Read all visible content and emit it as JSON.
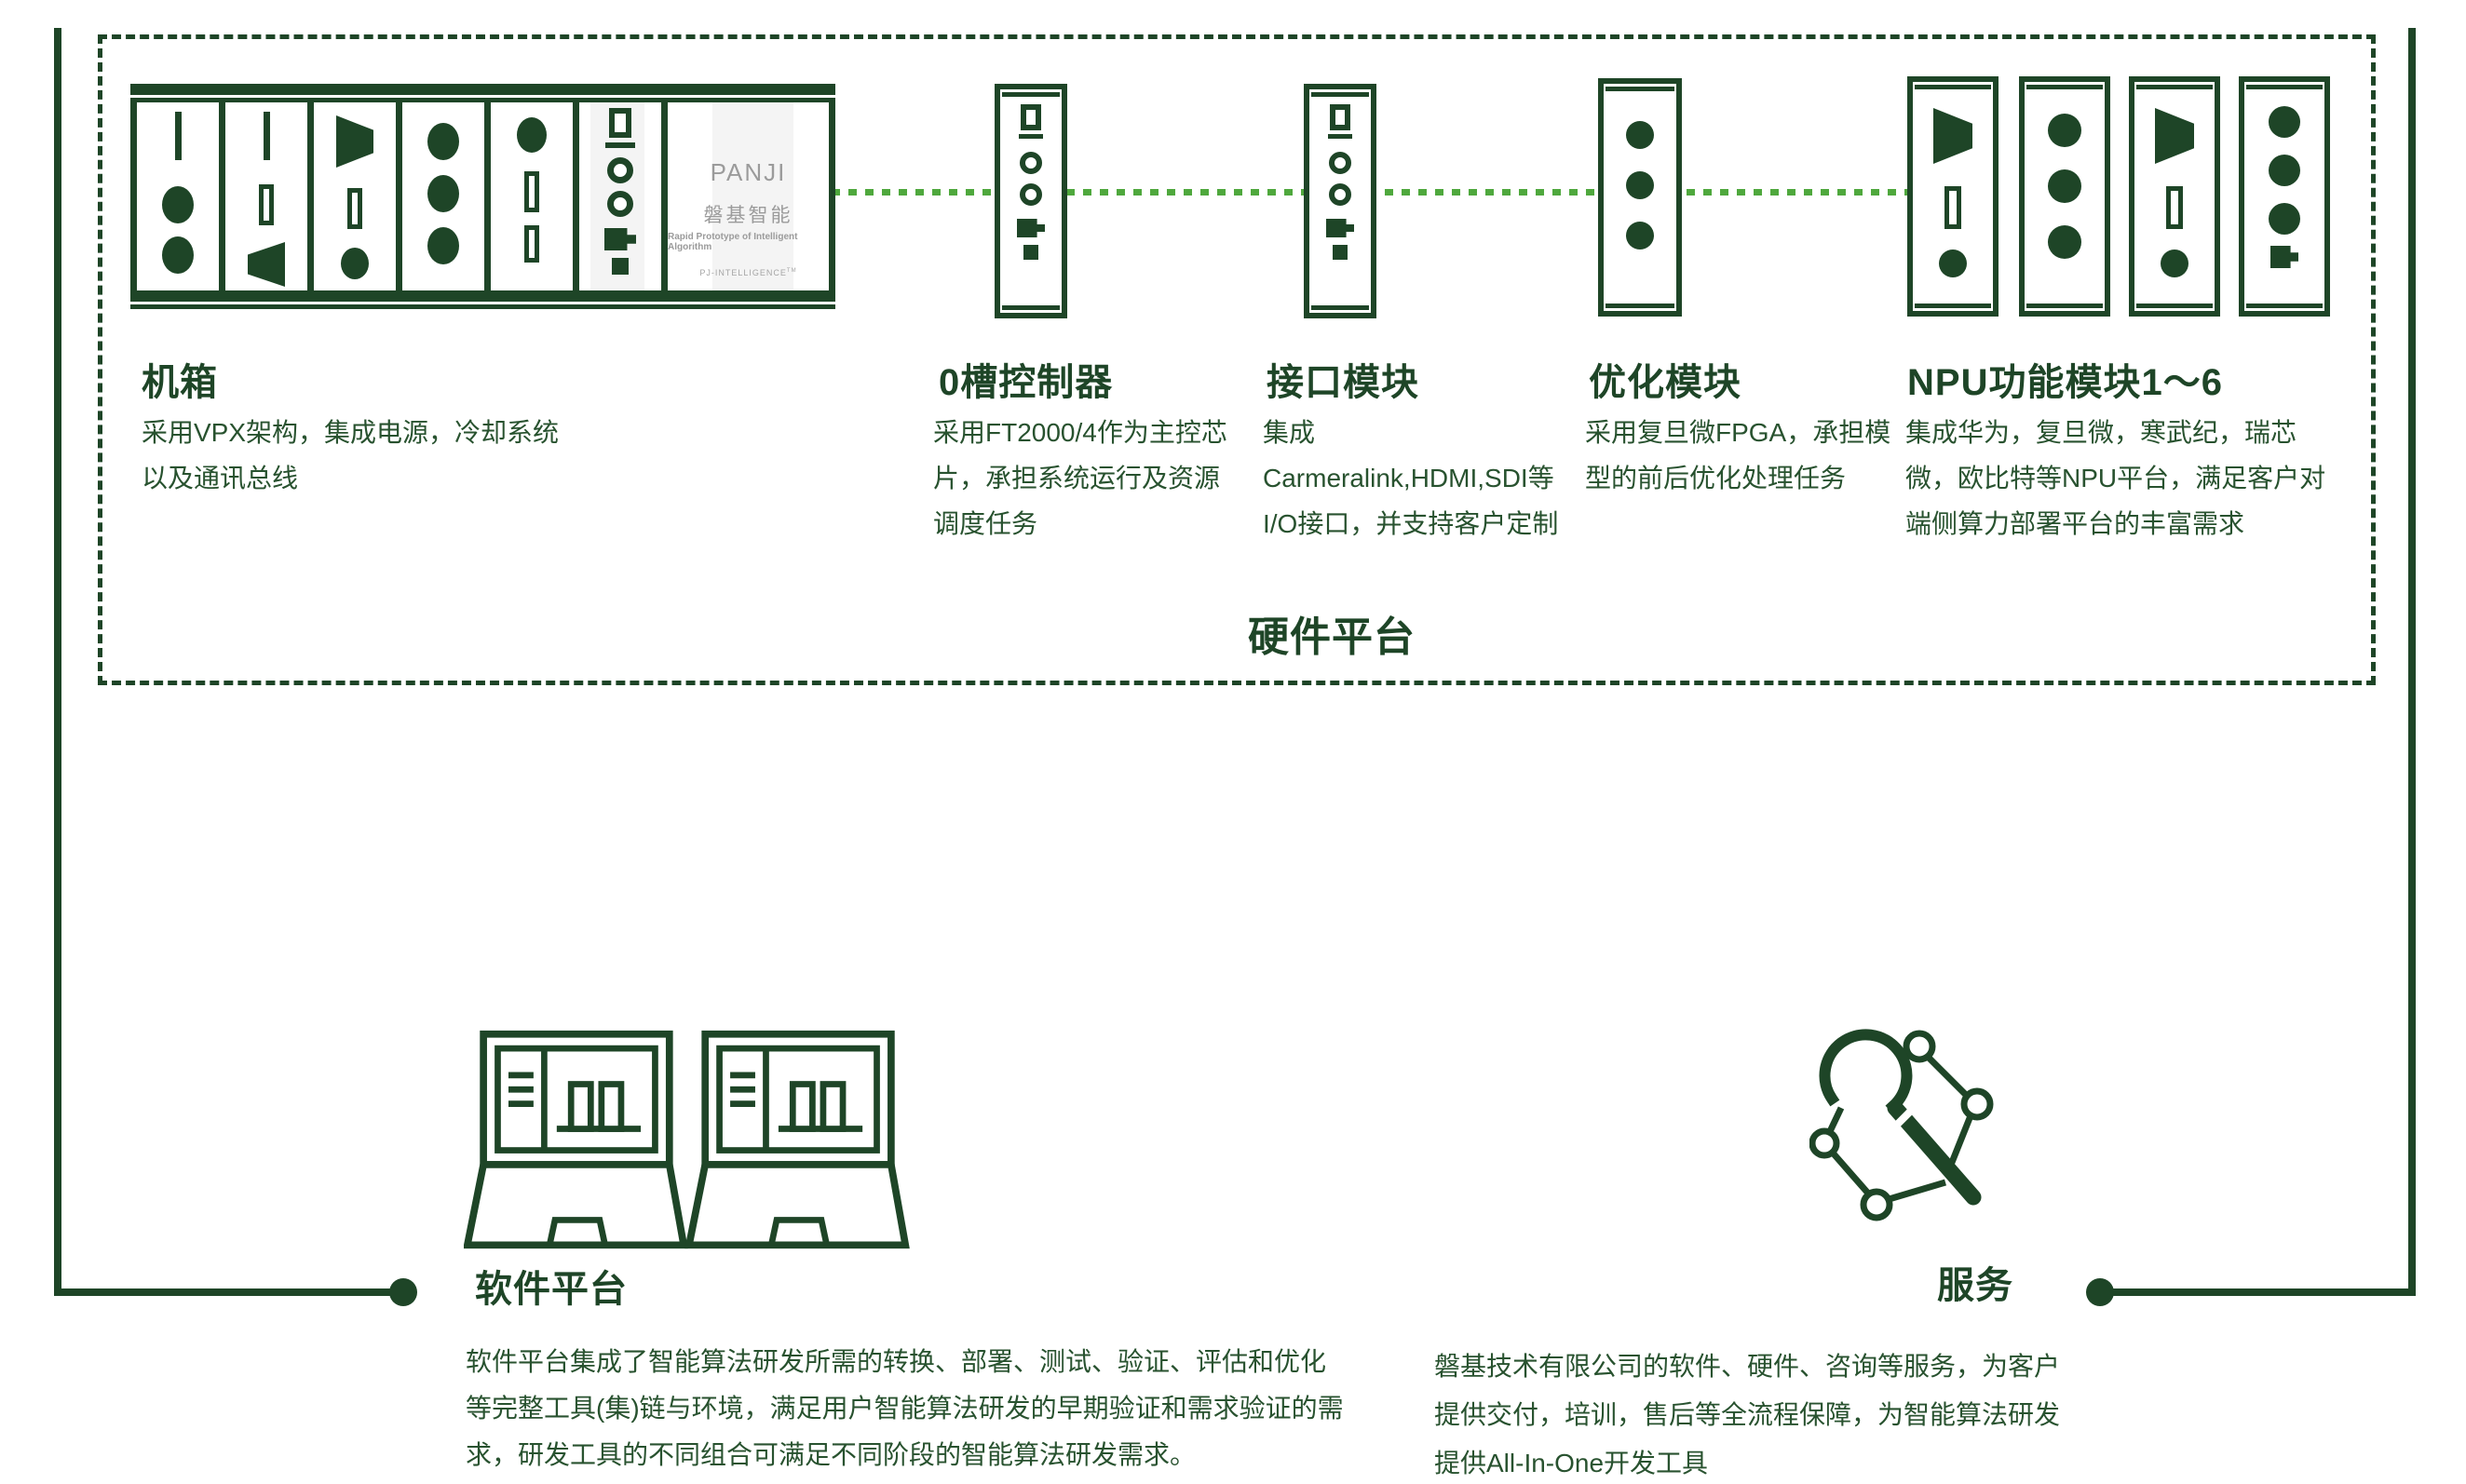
{
  "colors": {
    "dark_green": "#1E4527",
    "bright_green": "#4FA83D",
    "brand_gray": "#9B9B9B"
  },
  "hardware": {
    "box_label": "硬件平台",
    "chassis": {
      "title": "机箱",
      "desc": "采用VPX架构，集成电源，冷却系统以及通讯总线",
      "brand": {
        "name": "PANJI",
        "cn": "磐基智能",
        "tagline": "Rapid Prototype of Intelligent Algorithm",
        "footer": "PJ-INTELLIGENCE",
        "tm": "TM"
      }
    },
    "modules": [
      {
        "title": "0槽控制器",
        "desc": "采用FT2000/4作为主控芯片，承担系统运行及资源调度任务"
      },
      {
        "title": "接口模块",
        "desc": "集成Carmeralink,HDMI,SDI等I/O接口，并支持客户定制"
      },
      {
        "title": "优化模块",
        "desc": "采用复旦微FPGA，承担模型的前后优化处理任务"
      },
      {
        "title": "NPU功能模块1～6",
        "desc": "集成华为，复旦微，寒武纪，瑞芯微，欧比特等NPU平台，满足客户对端侧算力部署平台的丰富需求"
      }
    ]
  },
  "software": {
    "title": "软件平台",
    "desc": "软件平台集成了智能算法研发所需的转换、部署、测试、验证、评估和优化等完整工具(集)链与环境，满足用户智能算法研发的早期验证和需求验证的需求，研发工具的不同组合可满足不同阶段的智能算法研发需求。"
  },
  "service": {
    "title": "服务",
    "desc": "磐基技术有限公司的软件、硬件、咨询等服务，为客户提供交付，培训，售后等全流程保障，为智能算法研发提供All-In-One开发工具"
  }
}
